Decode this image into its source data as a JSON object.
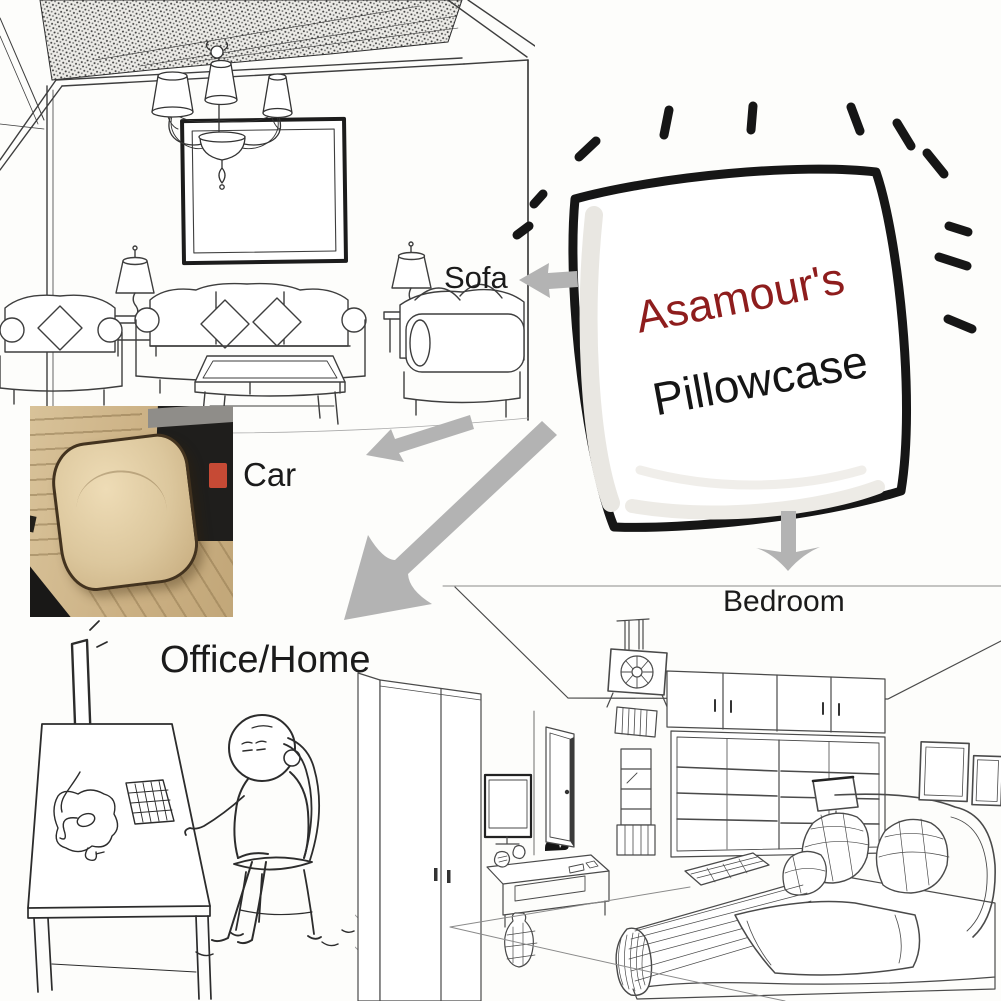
{
  "background": "#fdfdfb",
  "pillow": {
    "brand_text": "Asamour's",
    "product_text": "Pillowcase",
    "brand_color": "#8e1d1d",
    "product_color": "#151515",
    "outline_color": "#161616",
    "burst_dash_count": 11
  },
  "labels": {
    "sofa": "Sofa",
    "car": "Car",
    "office_home": "Office/Home",
    "bedroom": "Bedroom"
  },
  "colors": {
    "arrow": "#b3b3b3",
    "label_text": "#1b1b1b",
    "sketch_line": "#3e3e3e",
    "car_seat_beige": "#cbb083",
    "car_pillow_beige": "#dcc79d",
    "car_buckle_red": "#c64a35"
  },
  "arrows": {
    "color": "#b3b3b3",
    "items": [
      "arrow-to-sofa",
      "arrow-to-car",
      "arrow-to-office-home",
      "arrow-to-bedroom"
    ]
  }
}
